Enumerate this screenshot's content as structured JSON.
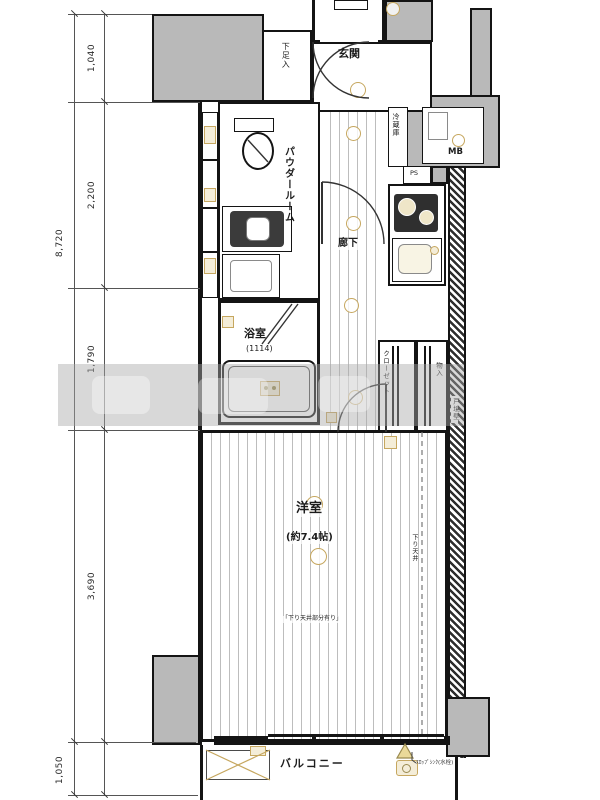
{
  "floorplan": {
    "rooms": {
      "genkan": "玄関",
      "powder": "パウダールーム",
      "corridor": "廊下",
      "bath": "浴室",
      "bath_size": "(1114)",
      "western": "洋室",
      "western_size": "(約7.4帖)",
      "balcony": "バルコニー"
    },
    "storage": {
      "shoe": "下足入",
      "closet": "クローゼット",
      "storage": "物入",
      "fridge": "冷蔵庫"
    },
    "labels": {
      "mb": "MB",
      "ps": "PS",
      "down_ceiling": "下り天井",
      "down_ceiling_note": "「下り天井部分有り」",
      "boundary_wall": "戸境壁",
      "balcony_note": "ｽﾛｯﾌﾟｼﾝｸ(水栓)"
    },
    "dimensions": {
      "total": "8,720",
      "seg1": "1,040",
      "seg2": "2,200",
      "seg3": "1,790",
      "seg4": "3,690",
      "balcony_depth": "1,050"
    },
    "colors": {
      "wall_fill": "#b9b9b9",
      "line": "#141414",
      "fixture_accent": "#c6a75f",
      "fixture_fill": "#f4edd8"
    }
  }
}
